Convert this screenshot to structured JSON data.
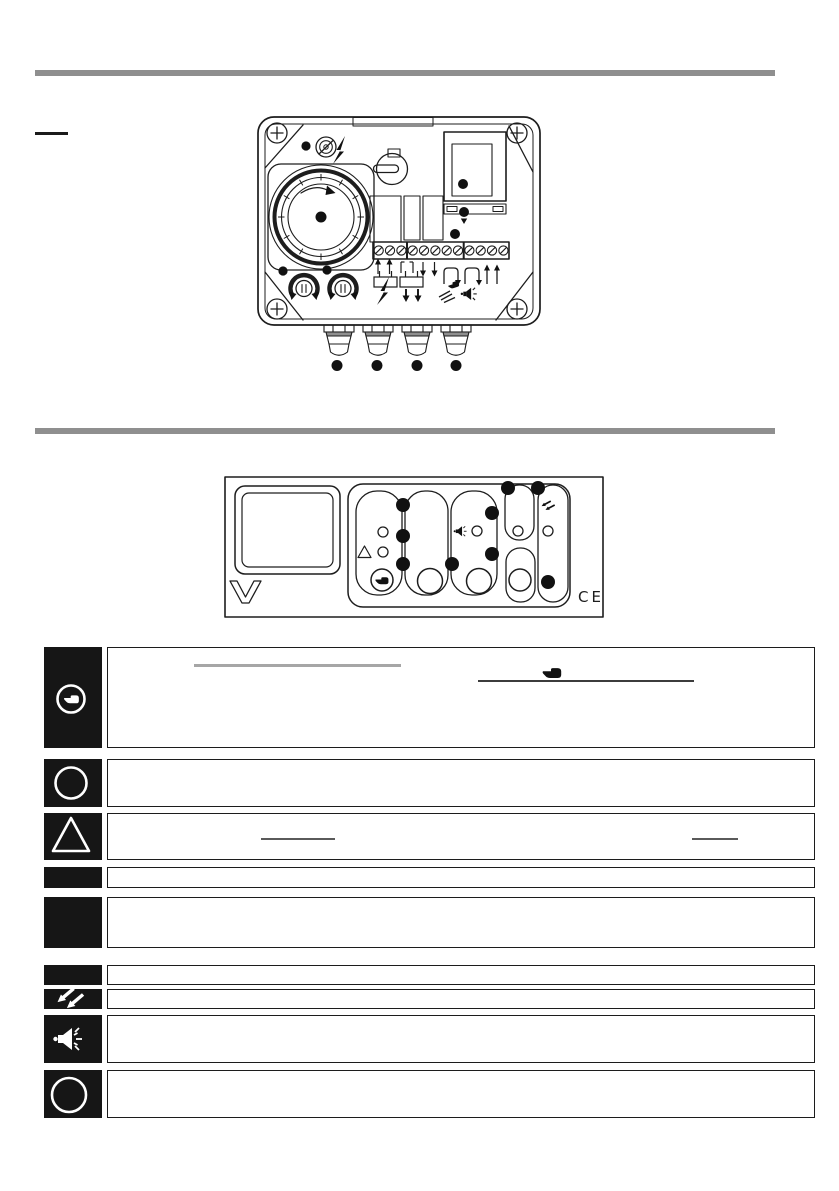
{
  "page": {
    "background": "#ffffff",
    "divider_color": "#8f8f8f",
    "ink_color": "#1d1d1d"
  },
  "figure_device": {
    "kind": "actuator-internal-view-line-drawing",
    "terminal_count": 12,
    "cable_gland_count": 4,
    "callout_dot_count": 11,
    "icons": [
      "corner-screw-icon",
      "lock-icon",
      "lightning-icon",
      "cam-dial",
      "selector-knob",
      "cover-window",
      "clamp-bar",
      "terminal-strip",
      "jumper-link-icon",
      "relay-contact-icon",
      "hand-waves-icon",
      "horn-icon",
      "potentiometer-knob",
      "cable-gland"
    ]
  },
  "figure_faceplate": {
    "kind": "control-faceplate-line-drawing",
    "ce_mark": "CE",
    "led_count": 5,
    "button_count": 4,
    "callout_dot_count": 9,
    "icons": [
      "display-window",
      "brand-v-logo",
      "triangle-icon",
      "hand-icon",
      "horn-icon",
      "fuel-arrows-icon"
    ]
  },
  "legend": {
    "rows": [
      {
        "icon": "hand-in-circle-icon",
        "text": "",
        "underline_count": 2
      },
      {
        "icon": "circle-icon",
        "text": "",
        "underline_count": 0
      },
      {
        "icon": "triangle-icon",
        "text": "",
        "underline_count": 2
      },
      {
        "icon": "blank",
        "text": "",
        "underline_count": 0
      },
      {
        "icon": "blank",
        "text": "",
        "underline_count": 0
      },
      {
        "icon": "blank",
        "text": "",
        "underline_count": 0
      },
      {
        "icon": "fuel-arrows-icon",
        "text": "",
        "underline_count": 0
      },
      {
        "icon": "horn-icon",
        "text": "",
        "underline_count": 0
      },
      {
        "icon": "circle-icon",
        "text": "",
        "underline_count": 0
      }
    ]
  }
}
